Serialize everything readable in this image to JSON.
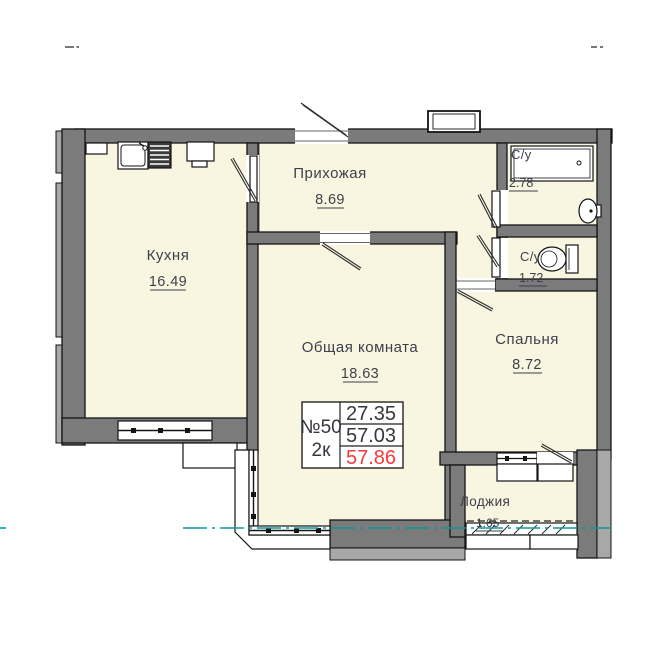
{
  "rooms": {
    "kitchen": {
      "label": "Кухня",
      "area": "16.49"
    },
    "hallway": {
      "label": "Прихожая",
      "area": "8.69"
    },
    "living_room": {
      "label": "Общая комната",
      "area": "18.63"
    },
    "bedroom": {
      "label": "Спальня",
      "area": "8.72"
    },
    "bathroom": {
      "label": "С/у",
      "area": "2.78"
    },
    "wc": {
      "label": "С/у",
      "area": "1.72"
    },
    "loggia": {
      "label": "Лоджия",
      "area": "1.65"
    }
  },
  "apartment_tag": {
    "number": "№50",
    "rooms": "2к",
    "areas": [
      "27.35",
      "57.03",
      "57.86"
    ]
  },
  "colors": {
    "room_fill": "#f8f6e1",
    "wall": "#7b7b7b",
    "wall_light": "#a8a8a8",
    "outline": "#141414",
    "text": "#3d3f4b",
    "highlight_red": "#f73b3b",
    "section_teal": "#0e9898"
  }
}
